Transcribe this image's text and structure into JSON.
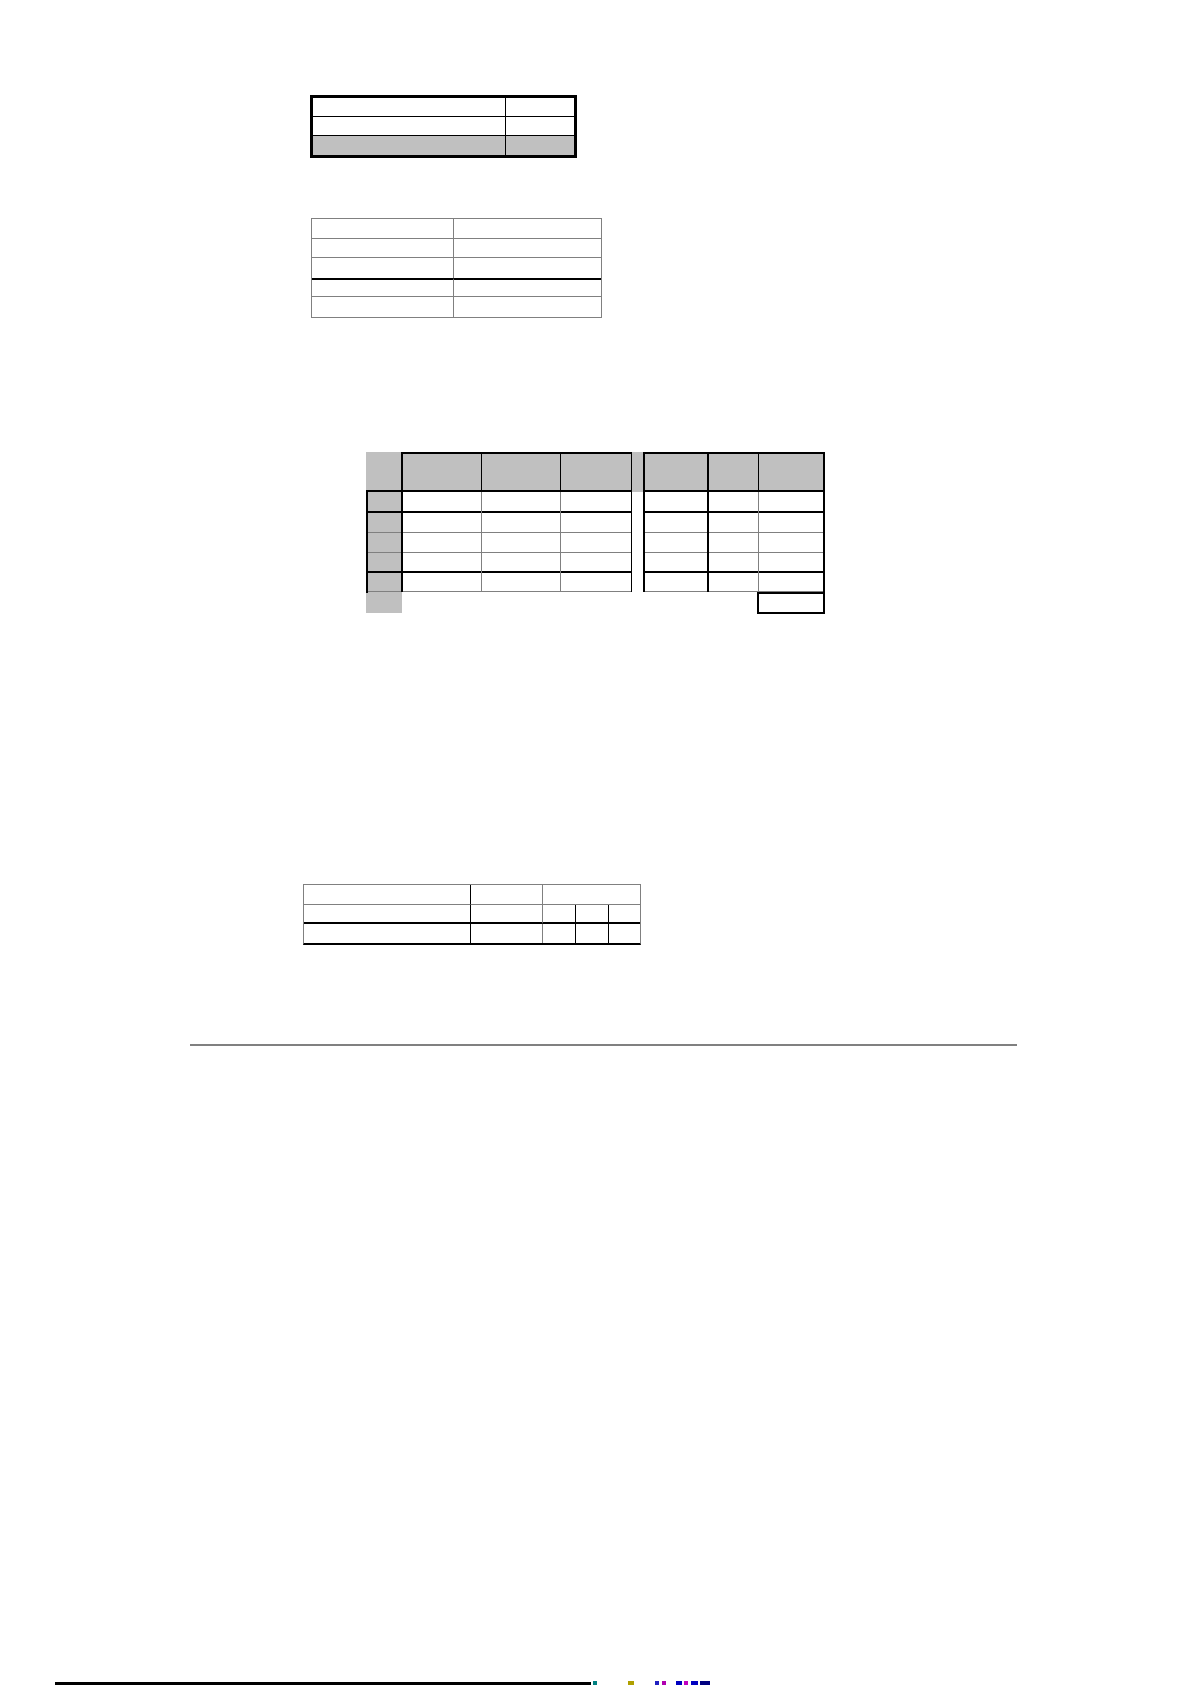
{
  "page": {
    "kind": "blank document page with empty tables",
    "width_px": 1191,
    "height_px": 1685,
    "background": "#ffffff"
  },
  "colors": {
    "table_shading_gray": "#c0c0c0",
    "thin_border_gray": "#808080",
    "thick_border_black": "#000000",
    "separator_line_gray": "#808080",
    "footer_rule_black": "#000000",
    "footer_fragment_colors": [
      "#008080",
      "#b0a000",
      "#2020c0",
      "#b000b0",
      "#0000c0",
      "#c000c0",
      "#000080"
    ]
  },
  "tables": [
    {
      "name": "table-1",
      "rows": 3,
      "columns": 2,
      "all_cells_empty": true,
      "shading": "entire last row shaded gray",
      "border_style": "thick black outer border, thin black inner rules"
    },
    {
      "name": "table-2",
      "rows": 5,
      "columns": 2,
      "all_cells_empty": true,
      "shading": "none",
      "border_style": "thin gray grid with a thick black rule above row 4"
    },
    {
      "name": "table-3",
      "header_row_height": "double height, shaded gray",
      "data_rows": 5,
      "column_groups": [
        {
          "group": "left",
          "columns": 4,
          "note": "first narrow stub column shaded gray in every row"
        },
        {
          "group": "right",
          "columns": 3
        }
      ],
      "gap_between_groups": "narrow unbordered strip, shaded only in header row",
      "extra_cells": [
        "unbordered gray stub cell below last data row at far left",
        "thick-bordered empty cell below last column at bottom right"
      ],
      "all_cells_empty": true
    },
    {
      "name": "table-4",
      "rows": 3,
      "columns_row1": 3,
      "columns_rows2_3": 5,
      "note": "last cell of row 1 splits into three narrow cells in rows 2 and 3",
      "all_cells_empty": true,
      "border_style": "thin gray outer border, thick black rule above row 3 and on bottom edge"
    }
  ],
  "separator": {
    "type": "horizontal rule",
    "description": "long thin gray horizontal line across page below tables"
  },
  "footer": {
    "rule": "thick black line segment at bottom-left, cut off by page edge",
    "text_fragments": "tops of small colored text characters clipped at the very bottom edge of the page"
  }
}
